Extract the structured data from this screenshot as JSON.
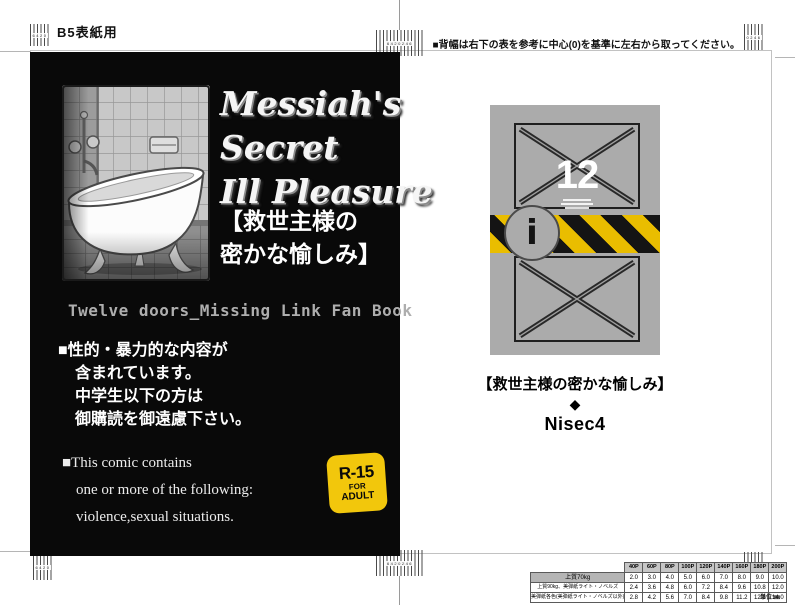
{
  "template": {
    "size_label": "B5表紙用",
    "instruction": "■背幅は右下の表を参考に中心(0)を基準に左右から取ってください。",
    "gauge_marks": {
      "left": "6420",
      "center": "6420246",
      "right": "0246"
    }
  },
  "front_cover": {
    "title_line1": "Messiah's",
    "title_line2": "Secret",
    "title_line3": "Ill Pleasure",
    "jp_title_line1": "【救世主様の",
    "jp_title_line2": "密かな愉しみ】",
    "series_note": "Twelve doors_Missing Link Fan Book",
    "warning_jp_line1": "■性的・暴力的な内容が",
    "warning_jp_line2": "含まれています。",
    "warning_jp_line3": "中学生以下の方は",
    "warning_jp_line4": "御購読を御遠慮下さい。",
    "warning_en_line1": "■This comic contains",
    "warning_en_line2": "one or more of the following:",
    "warning_en_line3": "violence,sexual situations.",
    "rating_badge": {
      "rating": "R-15",
      "sub1": "FOR",
      "sub2": "ADULT",
      "bg_color": "#f2c70c"
    }
  },
  "back_cover": {
    "page_count": "12",
    "info_mark": "i",
    "jp_title": "【救世主様の密かな愉しみ】",
    "separator": "◆",
    "circle_name": "Nisec4"
  },
  "spine_table": {
    "col_headers": [
      "40P",
      "60P",
      "80P",
      "100P",
      "120P",
      "140P",
      "160P",
      "180P",
      "200P"
    ],
    "rows": [
      {
        "label": "上質70kg",
        "values": [
          "2.0",
          "3.0",
          "4.0",
          "5.0",
          "6.0",
          "7.0",
          "8.0",
          "9.0",
          "10.0"
        ]
      },
      {
        "label": "上質90kg、美弾紙ライト・ノベルズ",
        "values": [
          "2.4",
          "3.6",
          "4.8",
          "6.0",
          "7.2",
          "8.4",
          "9.6",
          "10.8",
          "12.0"
        ]
      },
      {
        "label": "美弾紙各色(美弾紙ライト・ノベルズ以外)",
        "values": [
          "2.8",
          "4.2",
          "5.6",
          "7.0",
          "8.4",
          "9.8",
          "11.2",
          "12.6",
          "14.0"
        ]
      }
    ],
    "unit_note": "単位:㎜"
  },
  "colors": {
    "cover_bg": "#090909",
    "panel_gray": "#ababab",
    "caution_yellow": "#e9bd00"
  }
}
